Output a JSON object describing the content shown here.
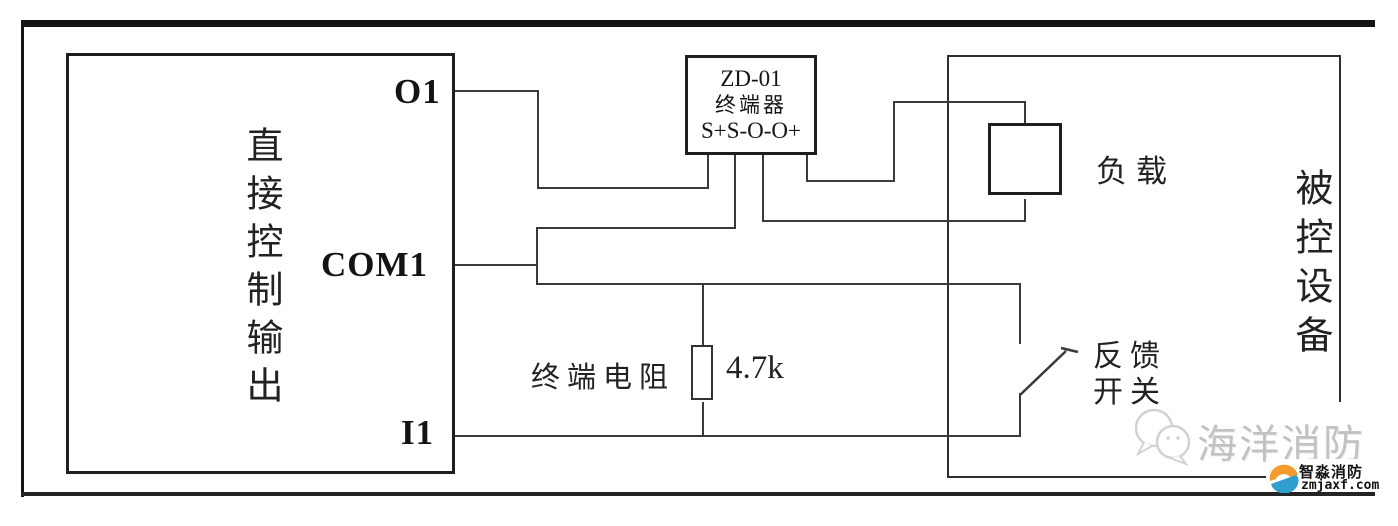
{
  "diagram": {
    "left_module": {
      "label": "直接控制输出",
      "terminals": {
        "o1": "O1",
        "com1": "COM1",
        "i1": "I1"
      }
    },
    "terminator": {
      "model": "ZD-01",
      "name": "终端器",
      "pins": "S+S-O-O+"
    },
    "terminal_resistor": {
      "label": "终端电阻",
      "value": "4.7k"
    },
    "load": {
      "label": "负载"
    },
    "feedback_switch": {
      "line1": "反馈",
      "line2": "开关"
    },
    "controlled_device": {
      "label": "被控设备"
    }
  },
  "watermarks": {
    "brand_text": "海洋消防",
    "logo_name": "智淼消防",
    "logo_domain": "zmjaxf.com"
  },
  "colors": {
    "line": "#3a3a3a",
    "watermark_grey": "#c2c2c2",
    "logo_orange": "#f39c2d",
    "logo_blue": "#2f9fd0"
  }
}
